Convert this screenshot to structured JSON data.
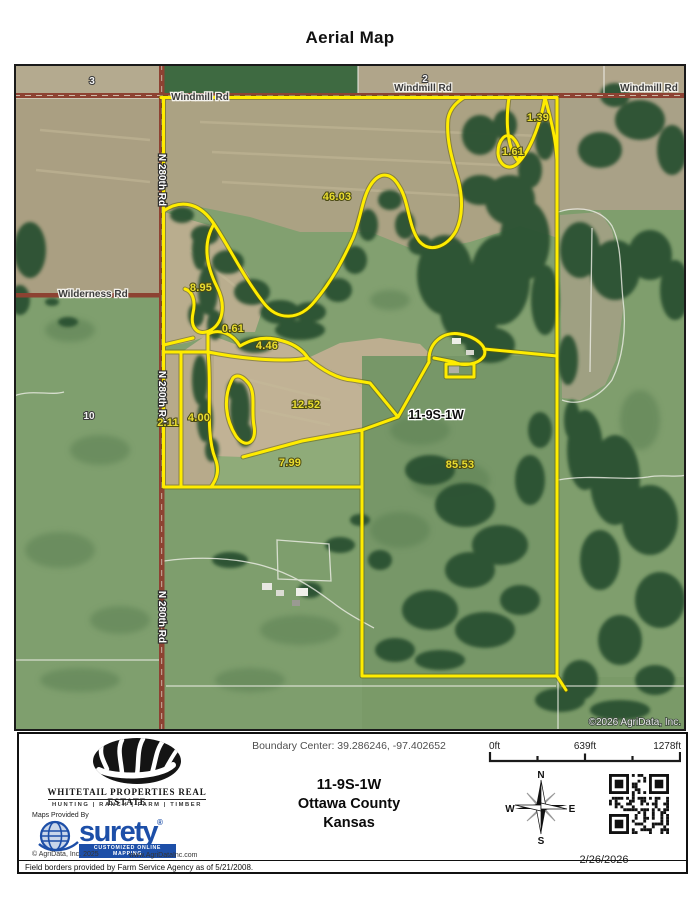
{
  "title": "Aerial Map",
  "map": {
    "roads": {
      "windmill": "Windmill Rd",
      "n280th": "N 280th Rd",
      "wilderness": "Wilderness Rd"
    },
    "sections": {
      "s3": "3",
      "s2": "2",
      "s10": "10"
    },
    "acreage_labels": [
      "1.39",
      "1.61",
      "46.03",
      "8.95",
      "0.61",
      "4.46",
      "12.52",
      "4.00",
      "2.11",
      "7.99",
      "85.53"
    ],
    "township_label": "11-9S-1W",
    "copyright": "©2026 AgriData, Inc."
  },
  "footer": {
    "whitetail": {
      "name": "WHITETAIL PROPERTIES REAL ESTATE",
      "tagline": "HUNTING | RANCH | FARM | TIMBER"
    },
    "maps_provided_by": "Maps Provided By",
    "surety": {
      "name": "surety",
      "registered": "®",
      "tagline": "CUSTOMIZED ONLINE MAPPING",
      "copyright": "© AgriData, Inc. 2025",
      "website": "www.AgriDataInc.com"
    },
    "boundary_center": "Boundary Center: 39.286246, -97.402652",
    "township": "11-9S-1W",
    "county": "Ottawa County",
    "state": "Kansas",
    "scale": {
      "start": "0ft",
      "middle": "639ft",
      "end": "1278ft"
    },
    "compass": {
      "n": "N",
      "s": "S",
      "e": "E",
      "w": "W"
    },
    "date": "2/26/2026",
    "disclaimer": "Field borders provided by Farm Service Agency as of 5/21/2008."
  },
  "colors": {
    "boundary": "#ffec00",
    "road": "#8d4232",
    "surety_blue": "#1d4fa8"
  }
}
